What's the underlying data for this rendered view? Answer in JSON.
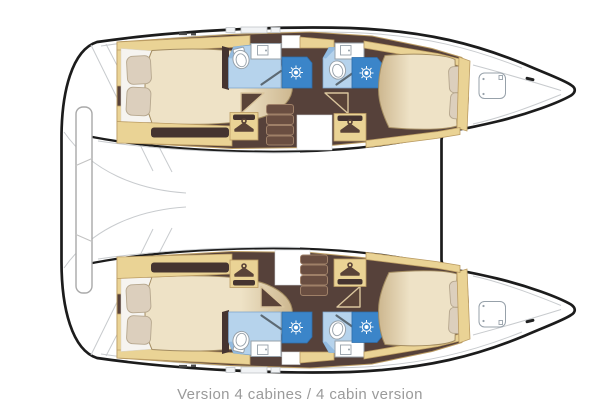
{
  "caption": "Version 4 cabines / 4 cabin version",
  "boat": {
    "layout_name": "4 cabin version",
    "hulls": [
      {
        "name": "port hull",
        "rooms": [
          "aft cabin",
          "aft bathroom",
          "forward bathroom",
          "forward cabin",
          "forepeak"
        ]
      },
      {
        "name": "starboard hull",
        "rooms": [
          "aft cabin",
          "aft bathroom",
          "forward bathroom",
          "forward cabin",
          "forepeak"
        ]
      }
    ],
    "fixtures_per_hull": {
      "double_beds": 2,
      "toilets": 2,
      "showers": 2,
      "sinks": 2,
      "wardrobes": 2,
      "companionway_steps": 1,
      "bow_hatch": 1
    },
    "icons": [
      "hanger-icon",
      "showerhead-icon",
      "toilet-icon",
      "sink-icon",
      "bow-hatch-icon"
    ]
  },
  "colors": {
    "outline": "#1c1c1c",
    "hull_fill": "#ffffff",
    "deck_line": "#c8cbce",
    "floor_brown": "#56413a",
    "floor_brown_dark": "#453430",
    "wood_trim": "#ead395",
    "wood_trim_border": "#bb9c63",
    "bed_light": "#eee2c6",
    "bed_dark": "#cdb78f",
    "bed_border": "#a38c61",
    "pillow": "#dccfbd",
    "pillow_border": "#b6a78e",
    "sheet_white": "#f6f4f0",
    "bath_light": "#b6d3ec",
    "bath_mid": "#93bbe0",
    "bath_border": "#7ba4cc",
    "shower_blue": "#3b85c9",
    "shower_dark": "#2e6dab",
    "fixture_line": "#97a1aa",
    "steps_fill": "#6a4e41",
    "steps_line": "#9f8068",
    "door_fill": "#5a4338",
    "door_line": "#dac59d",
    "caption_color": "#9a9a9a"
  }
}
